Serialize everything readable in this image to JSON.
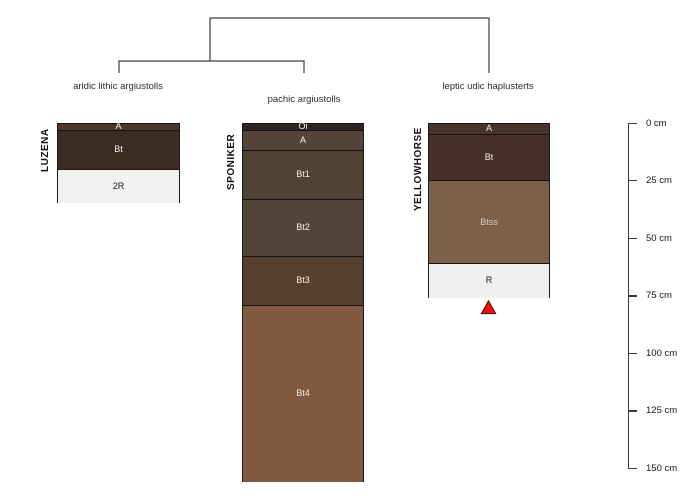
{
  "chart_data": {
    "type": "soil-profile-diagram-with-dendrogram",
    "dendrogram": {
      "structure": "((aridic lithic argiustolls + pachic argiustolls) + leptic udic haplusterts)",
      "leaves": [
        "aridic lithic argiustolls",
        "pachic argiustolls",
        "leptic udic haplusterts"
      ]
    },
    "depth_axis": {
      "unit": "cm",
      "ticks_cm": [
        0,
        25,
        50,
        75,
        100,
        125,
        150
      ],
      "tick_labels": [
        "0 cm",
        "25 cm",
        "50 cm",
        "75 cm",
        "100 cm",
        "125 cm",
        "150 cm"
      ]
    },
    "profiles": [
      {
        "name": "LUZENA",
        "taxon": "aridic lithic argiustolls",
        "horizons": [
          {
            "label": "A",
            "top_cm": 0,
            "bottom_cm": 3,
            "color": "#4b372c",
            "label_color": "#f7f3ee"
          },
          {
            "label": "Bt",
            "top_cm": 3,
            "bottom_cm": 20,
            "color": "#3c2b23",
            "label_color": "#f7f3ee"
          },
          {
            "label": "2R",
            "top_cm": 20,
            "bottom_cm": 35,
            "color": "#f2f1ef",
            "label_color": "#1a1a1a"
          }
        ]
      },
      {
        "name": "SPONIKER",
        "taxon": "pachic argiustolls",
        "horizons": [
          {
            "label": "Oi",
            "top_cm": 0,
            "bottom_cm": 3,
            "color": "#2e2522",
            "label_color": "#f7f3ee"
          },
          {
            "label": "A",
            "top_cm": 3,
            "bottom_cm": 12,
            "color": "#544538",
            "label_color": "#f7f3ee"
          },
          {
            "label": "Bt1",
            "top_cm": 12,
            "bottom_cm": 33,
            "color": "#514334",
            "label_color": "#f7f3ee"
          },
          {
            "label": "Bt2",
            "top_cm": 33,
            "bottom_cm": 58,
            "color": "#524436",
            "label_color": "#f7f3ee"
          },
          {
            "label": "Bt3",
            "top_cm": 58,
            "bottom_cm": 79,
            "color": "#573f2d",
            "label_color": "#f7f3ee"
          },
          {
            "label": "Bt4",
            "top_cm": 79,
            "bottom_cm": 156,
            "color": "#7f5a40",
            "label_color": "#f4ede6"
          }
        ]
      },
      {
        "name": "YELLOWHORSE",
        "taxon": "leptic udic haplusterts",
        "horizons": [
          {
            "label": "A",
            "top_cm": 0,
            "bottom_cm": 5,
            "color": "#47342b",
            "label_color": "#f7f3ee"
          },
          {
            "label": "Bt",
            "top_cm": 5,
            "bottom_cm": 25,
            "color": "#452f26",
            "label_color": "#f7f3ee"
          },
          {
            "label": "Btss",
            "top_cm": 25,
            "bottom_cm": 61,
            "color": "#7d6049",
            "label_color": "#d9cfc5"
          },
          {
            "label": "R",
            "top_cm": 61,
            "bottom_cm": 76,
            "color": "#f0efed",
            "label_color": "#1a1a1a"
          }
        ]
      }
    ],
    "marker": {
      "shape": "triangle",
      "color": "#ee1111",
      "attached_to_profile": "YELLOWHORSE",
      "position": "below profile bottom (76 cm)"
    }
  }
}
